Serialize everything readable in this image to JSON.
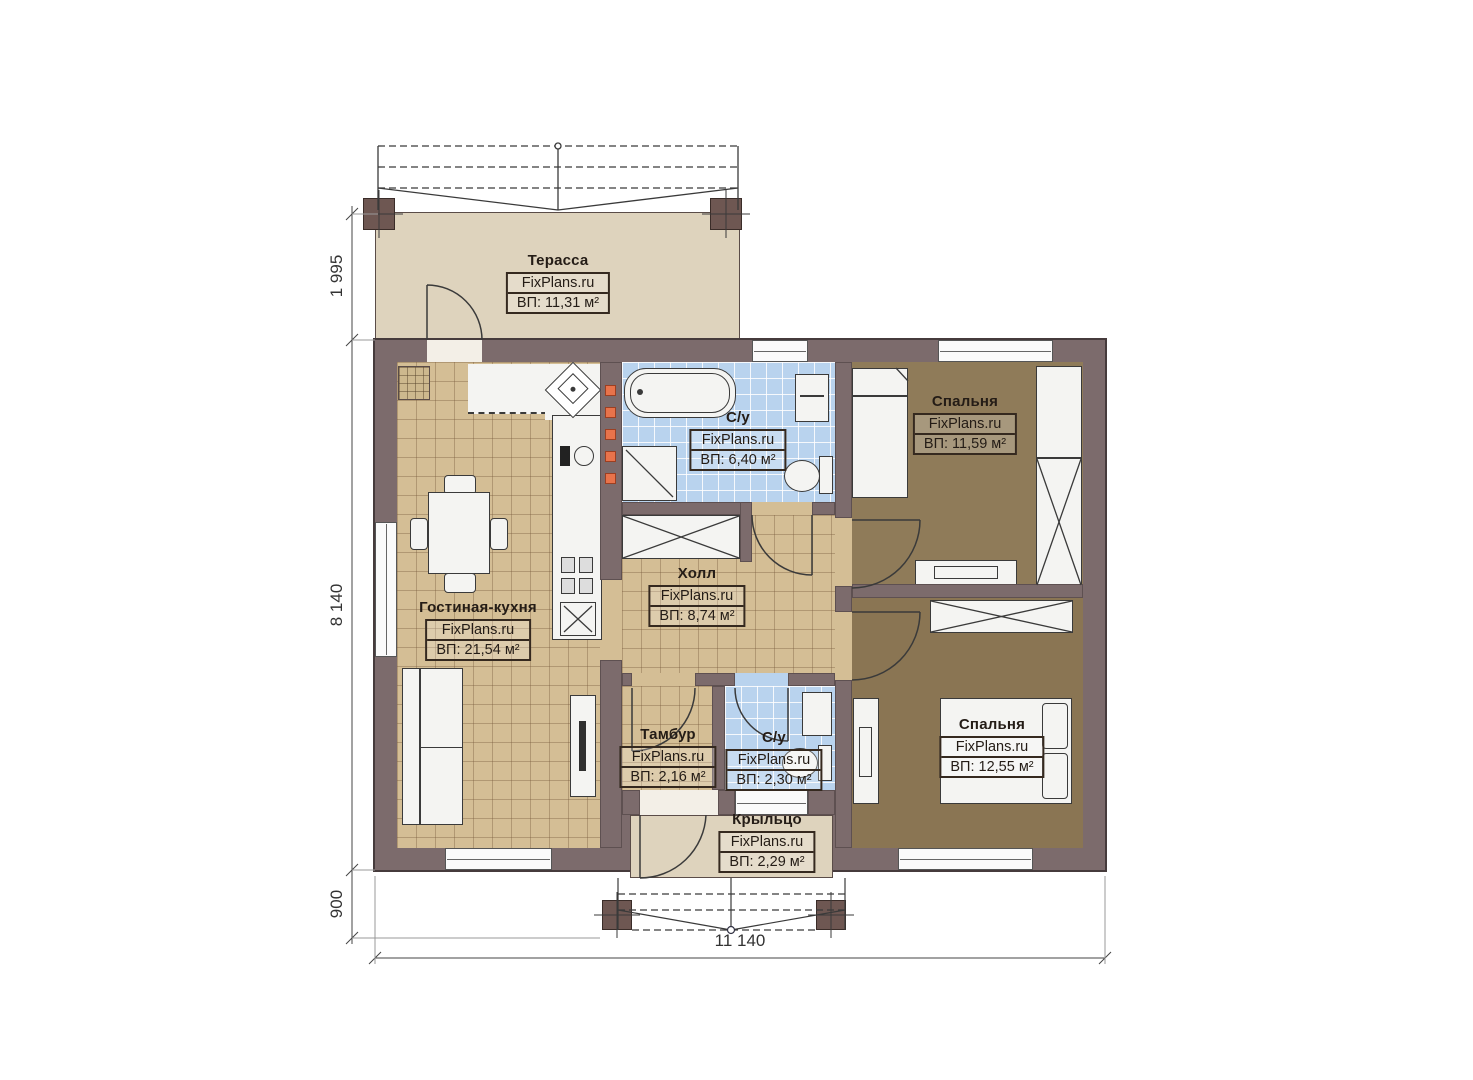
{
  "plan": {
    "rooms": {
      "terrace": {
        "name": "Терасса",
        "brand": "FixPlans.ru",
        "area": "ВП: 11,31 м²"
      },
      "bathroom1": {
        "name": "С/у",
        "brand": "FixPlans.ru",
        "area": "ВП: 6,40 м²"
      },
      "bedroom1": {
        "name": "Спальня",
        "brand": "FixPlans.ru",
        "area": "ВП: 11,59 м²"
      },
      "hall": {
        "name": "Холл",
        "brand": "FixPlans.ru",
        "area": "ВП: 8,74 м²"
      },
      "living_kitchen": {
        "name": "Гостиная-кухня",
        "brand": "FixPlans.ru",
        "area": "ВП: 21,54 м²"
      },
      "tambur": {
        "name": "Тамбур",
        "brand": "FixPlans.ru",
        "area": "ВП: 2,16 м²"
      },
      "bathroom2": {
        "name": "С/у",
        "brand": "FixPlans.ru",
        "area": "ВП: 2,30 м²"
      },
      "bedroom2": {
        "name": "Спальня",
        "brand": "FixPlans.ru",
        "area": "ВП: 12,55 м²"
      },
      "porch": {
        "name": "Крыльцо",
        "brand": "FixPlans.ru",
        "area": "ВП: 2,29 м²"
      }
    },
    "dimensions": {
      "terrace_depth": "1 995",
      "house_depth": "8 140",
      "porch_depth": "900",
      "house_width": "11 140"
    },
    "colors": {
      "wall": "#7c6b6c",
      "floor_tan": "#d4be95",
      "floor_blue": "#b9d3ee",
      "floor_bedroom": "#8e7a58",
      "floor_terrace": "#ded3bd",
      "accent_orange": "#e8734b"
    }
  }
}
